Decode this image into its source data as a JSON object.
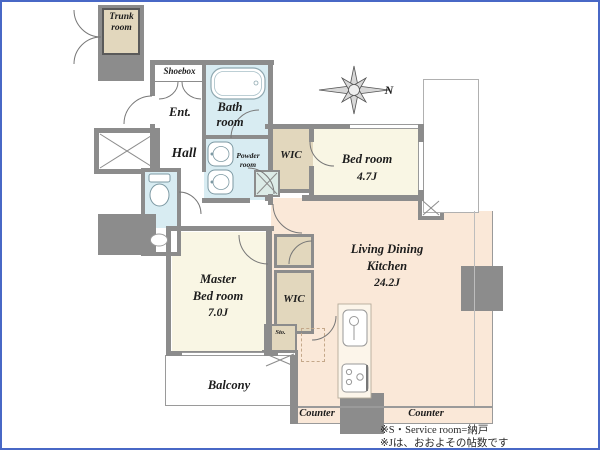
{
  "title": "apartment floor plan",
  "rooms": {
    "trunk": {
      "label": "Trunk room"
    },
    "shoebox": {
      "label": "Shoebox"
    },
    "bath": {
      "label": "Bath room"
    },
    "entrance": {
      "label": "Ent."
    },
    "hall": {
      "label": "Hall"
    },
    "powder": {
      "label": "Powder room"
    },
    "wic_upper": {
      "label": "WIC"
    },
    "bedroom": {
      "label": "Bed room",
      "size": "4.7J"
    },
    "ldk": {
      "label_line1": "Living Dining",
      "label_line2": "Kitchen",
      "size": "24.2J"
    },
    "master": {
      "label_line1": "Master",
      "label_line2": "Bed room",
      "size": "7.0J"
    },
    "wic_lower": {
      "label": "WIC"
    },
    "storage": {
      "label": "Sto."
    },
    "balcony": {
      "label": "Balcony"
    },
    "counter_left": {
      "label": "Counter"
    },
    "counter_right": {
      "label": "Counter"
    }
  },
  "compass": {
    "label": "N"
  },
  "notes": {
    "line1": "※S・Service room=納戸",
    "line2": "※Jは、おおよその帖数です"
  },
  "colors": {
    "frame_border": "#4868c6",
    "wall": "#8c8c8c",
    "bedroom_fill": "#f9f6e4",
    "living_fill": "#fae8d8",
    "closet_fill": "#e2d7bd",
    "wet_area_fill": "#d8ecf2"
  }
}
